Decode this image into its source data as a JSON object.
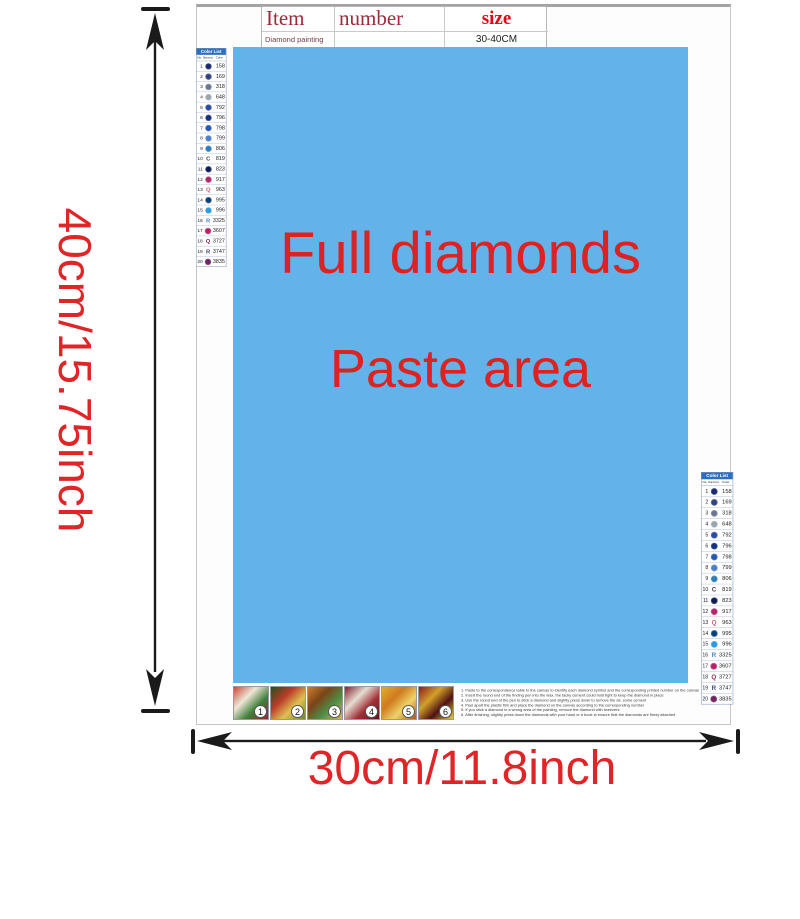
{
  "spec_table": {
    "col_item": "Item",
    "col_number": "number",
    "col_size": "size",
    "row_item": "Diamond painting",
    "row_number": "",
    "row_size": "30-40CM"
  },
  "canvas": {
    "line1": "Full diamonds",
    "line2": "Paste area",
    "area_color": "#63b3ea",
    "text_color": "#dd2222"
  },
  "dimensions": {
    "height_label": "40cm/15.75inch",
    "width_label": "30cm/11.8inch",
    "label_color": "#e02528",
    "arrow_color": "#1a1a1a"
  },
  "color_list": {
    "title": "Color List",
    "col_no": "No.",
    "col_diamond": "Diamond",
    "col_color": "Color",
    "header_bg": "#2f6fbe",
    "rows": [
      {
        "no": "1",
        "symbol_type": "circle",
        "symbol_color": "#1b2a70",
        "code": "158"
      },
      {
        "no": "2",
        "symbol_type": "circle",
        "symbol_color": "#32427e",
        "code": "169"
      },
      {
        "no": "3",
        "symbol_type": "circle",
        "symbol_color": "#6a7690",
        "code": "318"
      },
      {
        "no": "4",
        "symbol_type": "circle",
        "symbol_color": "#9aa6ae",
        "code": "648"
      },
      {
        "no": "5",
        "symbol_type": "circle",
        "symbol_color": "#2c4a9e",
        "code": "792"
      },
      {
        "no": "6",
        "symbol_type": "circle",
        "symbol_color": "#142f84",
        "code": "796"
      },
      {
        "no": "7",
        "symbol_type": "circle",
        "symbol_color": "#2857b0",
        "code": "798"
      },
      {
        "no": "8",
        "symbol_type": "circle",
        "symbol_color": "#4e7ecb",
        "code": "799"
      },
      {
        "no": "9",
        "symbol_type": "circle",
        "symbol_color": "#2e7cb8",
        "code": "806"
      },
      {
        "no": "10",
        "symbol_type": "letter",
        "symbol_letter": "C",
        "symbol_color": "#444444",
        "code": "819"
      },
      {
        "no": "11",
        "symbol_type": "circle",
        "symbol_color": "#0f1c54",
        "code": "823"
      },
      {
        "no": "12",
        "symbol_type": "circle",
        "symbol_color": "#b32568",
        "code": "917"
      },
      {
        "no": "13",
        "symbol_type": "letter",
        "symbol_letter": "Q",
        "symbol_color": "#c4607a",
        "code": "963"
      },
      {
        "no": "14",
        "symbol_type": "circle",
        "symbol_color": "#0d3f77",
        "code": "995"
      },
      {
        "no": "15",
        "symbol_type": "circle",
        "symbol_color": "#2a9ae0",
        "code": "996"
      },
      {
        "no": "16",
        "symbol_type": "letter",
        "symbol_letter": "R",
        "symbol_color": "#4a84c8",
        "code": "3325"
      },
      {
        "no": "17",
        "symbol_type": "circle",
        "symbol_color": "#bb2064",
        "code": "3607"
      },
      {
        "no": "18",
        "symbol_type": "letter",
        "symbol_letter": "Q",
        "symbol_color": "#8d2a50",
        "code": "3727"
      },
      {
        "no": "19",
        "symbol_type": "letter",
        "symbol_letter": "R",
        "symbol_color": "#3c4a78",
        "code": "3747"
      },
      {
        "no": "20",
        "symbol_type": "circle",
        "symbol_color": "#6e2560",
        "code": "3835"
      }
    ]
  },
  "steps": {
    "images": [
      {
        "label": "1",
        "colors": [
          "#c84a32",
          "#efe6d8",
          "#3f7f3a",
          "#9a2424"
        ]
      },
      {
        "label": "2",
        "colors": [
          "#244f1e",
          "#b93a28",
          "#e0c050",
          "#6a8a30"
        ]
      },
      {
        "label": "3",
        "colors": [
          "#c8802a",
          "#7a4418",
          "#4f8f46",
          "#d8b060"
        ]
      },
      {
        "label": "4",
        "colors": [
          "#801f2f",
          "#e6ded2",
          "#a03038",
          "#5f1420"
        ]
      },
      {
        "label": "5",
        "colors": [
          "#e0b02f",
          "#cf7a1e",
          "#efd268",
          "#b05818"
        ]
      },
      {
        "label": "6",
        "colors": [
          "#8a1d1d",
          "#d2a02a",
          "#4f1212",
          "#e8c84a"
        ]
      }
    ],
    "instructions": [
      "1. Paste to the correspondence table to the canvas to identify each diamond symbol and the corresponding printed number on the canvas",
      "2. Insert the round end of the finding pen into the wax, the tacky cement could hold tight to keep the diamond in place",
      "3. Use the round end of the pen to stick a diamond and slightly press down to remove the air, some cement",
      "4. Peel apart the plastic film and place the diamond on the canvas according to the corresponding number",
      "5. If you stick a diamond in a wrong area of the painting, remove the diamond with tweezers",
      "6. After finishing, slightly press down the diamonds with your hand or a book to ensure that the diamonds are firmly attached"
    ]
  }
}
